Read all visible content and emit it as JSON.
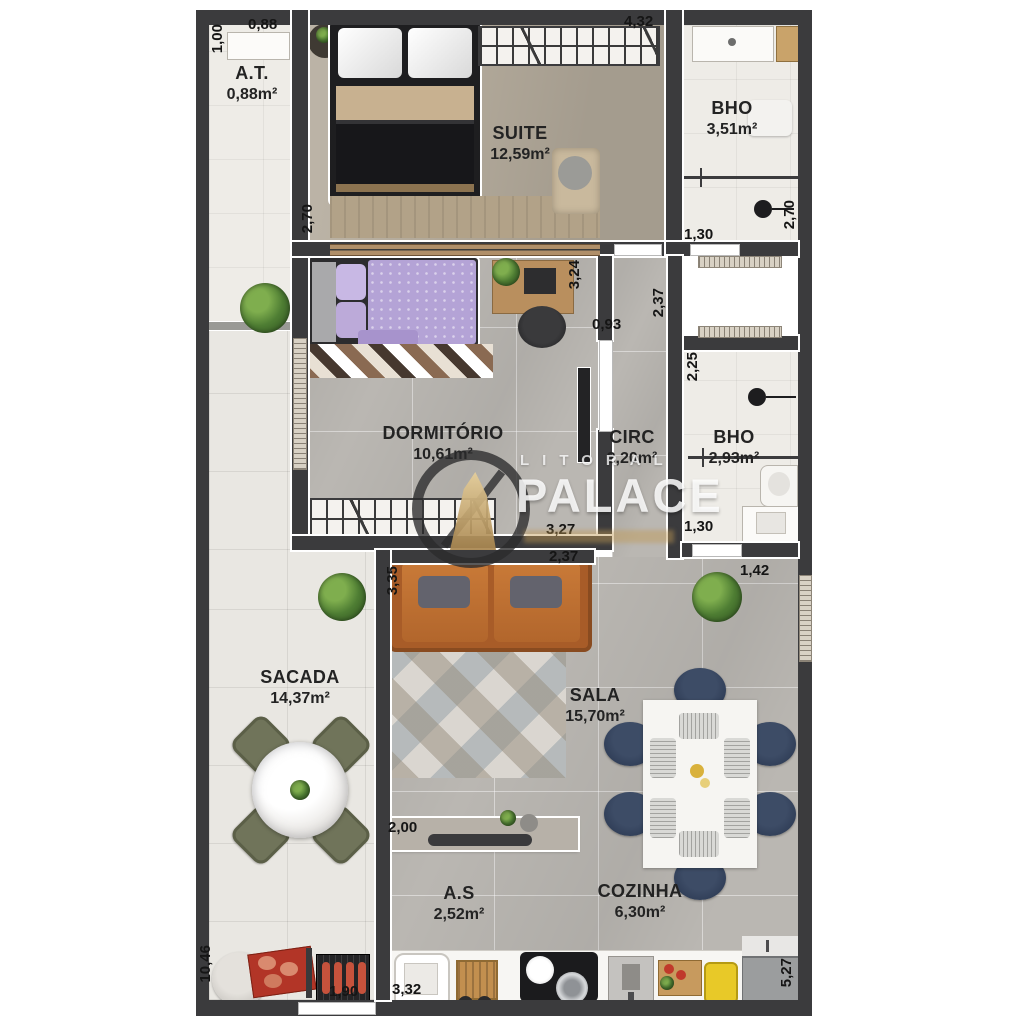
{
  "watermark": {
    "brand_top": "LITORAL",
    "brand_main": "PALACE"
  },
  "rooms": [
    {
      "name": "A.T.",
      "area": "0,88m²"
    },
    {
      "name": "SUITE",
      "area": "12,59m²"
    },
    {
      "name": "BHO",
      "area": "3,51m²"
    },
    {
      "name": "DORMITÓRIO",
      "area": "10,61m²"
    },
    {
      "name": "CIRC",
      "area": "2,20m²"
    },
    {
      "name": "BHO",
      "area": "2,93m²"
    },
    {
      "name": "SACADA",
      "area": "14,37m²"
    },
    {
      "name": "SALA",
      "area": "15,70m²"
    },
    {
      "name": "A.S",
      "area": "2,52m²"
    },
    {
      "name": "COZINHA",
      "area": "6,30m²"
    }
  ],
  "dims": [
    "1,00",
    "0,88",
    "4,32",
    "2,70",
    "1,30",
    "2,70",
    "3,24",
    "0,93",
    "2,37",
    "2,25",
    "1,30",
    "3,27",
    "2,37",
    "3,35",
    "1,42",
    "2,00",
    "10,46",
    "1,90",
    "3,32",
    "5,27"
  ]
}
